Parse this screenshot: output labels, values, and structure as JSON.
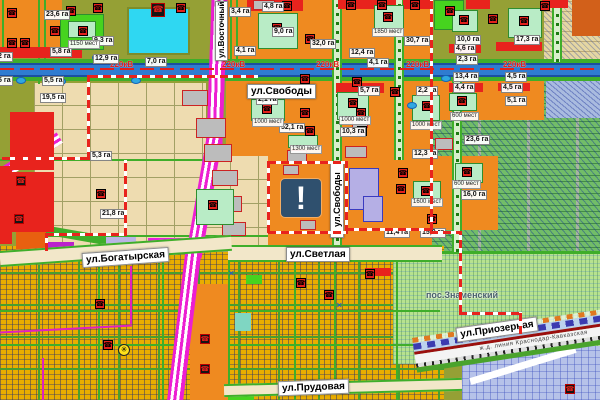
{
  "map": {
    "marker": {
      "glyph": "!"
    },
    "streets": {
      "vostochny": "ул.Восточный Обход",
      "svobody": "ул.Свободы",
      "svetlaya": "ул.Светлая",
      "bogatyrskaya": "ул.Богатырская",
      "prudovaya": "ул.Прудовая",
      "priozernaya": "ул.Приозерная",
      "settlement": "пос.Знаменский",
      "railway": "ж.д. линия Краснодар-Кавказская",
      "power": "220кВ"
    },
    "area_labels": [
      {
        "x": 44,
        "y": 10,
        "t": "23,6 га"
      },
      {
        "x": 50,
        "y": 47,
        "t": "5,8 га"
      },
      {
        "x": 92,
        "y": 36,
        "t": "9,3 га"
      },
      {
        "x": 93,
        "y": 54,
        "t": "12,9 га"
      },
      {
        "x": 145,
        "y": 57,
        "t": "7,0 га"
      },
      {
        "x": -4,
        "y": 52,
        "t": "2 га"
      },
      {
        "x": -4,
        "y": 76,
        "t": "5 га"
      },
      {
        "x": 42,
        "y": 76,
        "t": "5,5 га"
      },
      {
        "x": 40,
        "y": 93,
        "t": "19,5 га"
      },
      {
        "x": 90,
        "y": 151,
        "t": "5,3 га"
      },
      {
        "x": 100,
        "y": 209,
        "t": "21,8 га"
      },
      {
        "x": 229,
        "y": 7,
        "t": "3,4 га"
      },
      {
        "x": 262,
        "y": 2,
        "t": "4,8 га"
      },
      {
        "x": 272,
        "y": 27,
        "t": "9,0 га"
      },
      {
        "x": 234,
        "y": 46,
        "t": "4,1 га"
      },
      {
        "x": 310,
        "y": 39,
        "t": "32,0 га"
      },
      {
        "x": 349,
        "y": 48,
        "t": "12,4 га"
      },
      {
        "x": 367,
        "y": 58,
        "t": "4,1 га"
      },
      {
        "x": 404,
        "y": 36,
        "t": "30,7 га"
      },
      {
        "x": 256,
        "y": 95,
        "t": "2,1 га"
      },
      {
        "x": 279,
        "y": 123,
        "t": "52,1 га"
      },
      {
        "x": 340,
        "y": 127,
        "t": "10,3 га"
      },
      {
        "x": 358,
        "y": 86,
        "t": "5,7 га"
      },
      {
        "x": 416,
        "y": 86,
        "t": "2,2 га"
      },
      {
        "x": 455,
        "y": 35,
        "t": "10,0 га"
      },
      {
        "x": 514,
        "y": 35,
        "t": "17,3 га"
      },
      {
        "x": 454,
        "y": 44,
        "t": "4,6 га"
      },
      {
        "x": 456,
        "y": 55,
        "t": "2,3 га"
      },
      {
        "x": 453,
        "y": 72,
        "t": "13,4 га"
      },
      {
        "x": 505,
        "y": 72,
        "t": "4,5 га"
      },
      {
        "x": 453,
        "y": 83,
        "t": "4,4 га"
      },
      {
        "x": 501,
        "y": 83,
        "t": "4,5 га"
      },
      {
        "x": 505,
        "y": 96,
        "t": "5,1 га"
      },
      {
        "x": 412,
        "y": 149,
        "t": "12,3 га"
      },
      {
        "x": 464,
        "y": 135,
        "t": "23,6 га"
      },
      {
        "x": 461,
        "y": 190,
        "t": "16,0 га"
      },
      {
        "x": 420,
        "y": 228,
        "t": "15,0 га"
      },
      {
        "x": 384,
        "y": 228,
        "t": "11,4 га"
      }
    ],
    "capacity_labels": [
      {
        "x": 68,
        "y": 40,
        "t": "1150 мест"
      },
      {
        "x": 252,
        "y": 118,
        "t": "1000 мест"
      },
      {
        "x": 339,
        "y": 116,
        "t": "1000 мест"
      },
      {
        "x": 410,
        "y": 121,
        "t": "1000 мест"
      },
      {
        "x": 450,
        "y": 112,
        "t": "600 мест"
      },
      {
        "x": 452,
        "y": 180,
        "t": "600 мест"
      },
      {
        "x": 411,
        "y": 198,
        "t": "1600 мест"
      },
      {
        "x": 290,
        "y": 145,
        "t": "1300 мест"
      },
      {
        "x": 372,
        "y": 28,
        "t": "1850 мест"
      }
    ],
    "icon_glyphs": {
      "r": "☎",
      "b": "☎",
      "c": "✳"
    },
    "icons": [
      {
        "x": 7,
        "y": 8,
        "k": "r"
      },
      {
        "x": 7,
        "y": 38,
        "k": "r"
      },
      {
        "x": 20,
        "y": 38,
        "k": "r"
      },
      {
        "x": 50,
        "y": 26,
        "k": "r"
      },
      {
        "x": 66,
        "y": 6,
        "k": "r"
      },
      {
        "x": 93,
        "y": 3,
        "k": "r"
      },
      {
        "x": 176,
        "y": 3,
        "k": "r"
      },
      {
        "x": 282,
        "y": 1,
        "k": "r"
      },
      {
        "x": 305,
        "y": 34,
        "k": "r"
      },
      {
        "x": 346,
        "y": 0,
        "k": "r"
      },
      {
        "x": 377,
        "y": 0,
        "k": "r"
      },
      {
        "x": 410,
        "y": 0,
        "k": "r"
      },
      {
        "x": 445,
        "y": 6,
        "k": "r"
      },
      {
        "x": 459,
        "y": 15,
        "k": "r"
      },
      {
        "x": 519,
        "y": 16,
        "k": "r"
      },
      {
        "x": 540,
        "y": 1,
        "k": "r"
      },
      {
        "x": 488,
        "y": 14,
        "k": "r"
      },
      {
        "x": 300,
        "y": 74,
        "k": "r"
      },
      {
        "x": 352,
        "y": 77,
        "k": "r"
      },
      {
        "x": 390,
        "y": 87,
        "k": "r"
      },
      {
        "x": 300,
        "y": 108,
        "k": "r"
      },
      {
        "x": 356,
        "y": 108,
        "k": "r"
      },
      {
        "x": 305,
        "y": 126,
        "k": "r"
      },
      {
        "x": 357,
        "y": 126,
        "k": "r"
      },
      {
        "x": 262,
        "y": 104,
        "k": "r"
      },
      {
        "x": 348,
        "y": 98,
        "k": "r"
      },
      {
        "x": 422,
        "y": 101,
        "k": "r"
      },
      {
        "x": 457,
        "y": 96,
        "k": "r"
      },
      {
        "x": 462,
        "y": 167,
        "k": "r"
      },
      {
        "x": 421,
        "y": 186,
        "k": "r"
      },
      {
        "x": 427,
        "y": 214,
        "k": "r"
      },
      {
        "x": 398,
        "y": 168,
        "k": "r"
      },
      {
        "x": 396,
        "y": 184,
        "k": "r"
      },
      {
        "x": 208,
        "y": 200,
        "k": "r"
      },
      {
        "x": 96,
        "y": 189,
        "k": "r"
      },
      {
        "x": 272,
        "y": 23,
        "k": "r"
      },
      {
        "x": 78,
        "y": 26,
        "k": "r"
      },
      {
        "x": 383,
        "y": 12,
        "k": "r"
      },
      {
        "x": 296,
        "y": 278,
        "k": "r"
      },
      {
        "x": 324,
        "y": 290,
        "k": "r"
      },
      {
        "x": 365,
        "y": 269,
        "k": "r"
      },
      {
        "x": 95,
        "y": 299,
        "k": "r"
      },
      {
        "x": 103,
        "y": 340,
        "k": "r"
      },
      {
        "x": 151,
        "y": 3,
        "k": "b"
      },
      {
        "x": 16,
        "y": 176,
        "k": "b"
      },
      {
        "x": 14,
        "y": 214,
        "k": "b"
      },
      {
        "x": 200,
        "y": 334,
        "k": "b"
      },
      {
        "x": 200,
        "y": 364,
        "k": "b"
      },
      {
        "x": 565,
        "y": 384,
        "k": "b"
      },
      {
        "x": 118,
        "y": 344,
        "k": "c"
      }
    ],
    "ponds": [
      [
        92,
        54
      ],
      [
        16,
        77
      ],
      [
        56,
        78
      ],
      [
        131,
        77
      ],
      [
        441,
        75
      ],
      [
        515,
        75
      ],
      [
        407,
        102
      ]
    ],
    "power_positions": [
      110,
      222,
      316,
      406,
      503
    ],
    "colors": {
      "residential_orange": "#ef8a20",
      "planned_beige": "#eedcb0",
      "existing_yellow": "#e9ad00",
      "gardens_green": "#72bd68",
      "settlement_green": "#b7e28f",
      "water_cyan": "#2fd7f2",
      "road_blue": "#2f7cd0",
      "verge_green": "#3fae2a",
      "boundary_red": "#e8231d",
      "arterial_magenta": "#ec1fd2",
      "marker_navy": "#2f506e",
      "icon_red": "#e3201b"
    }
  }
}
